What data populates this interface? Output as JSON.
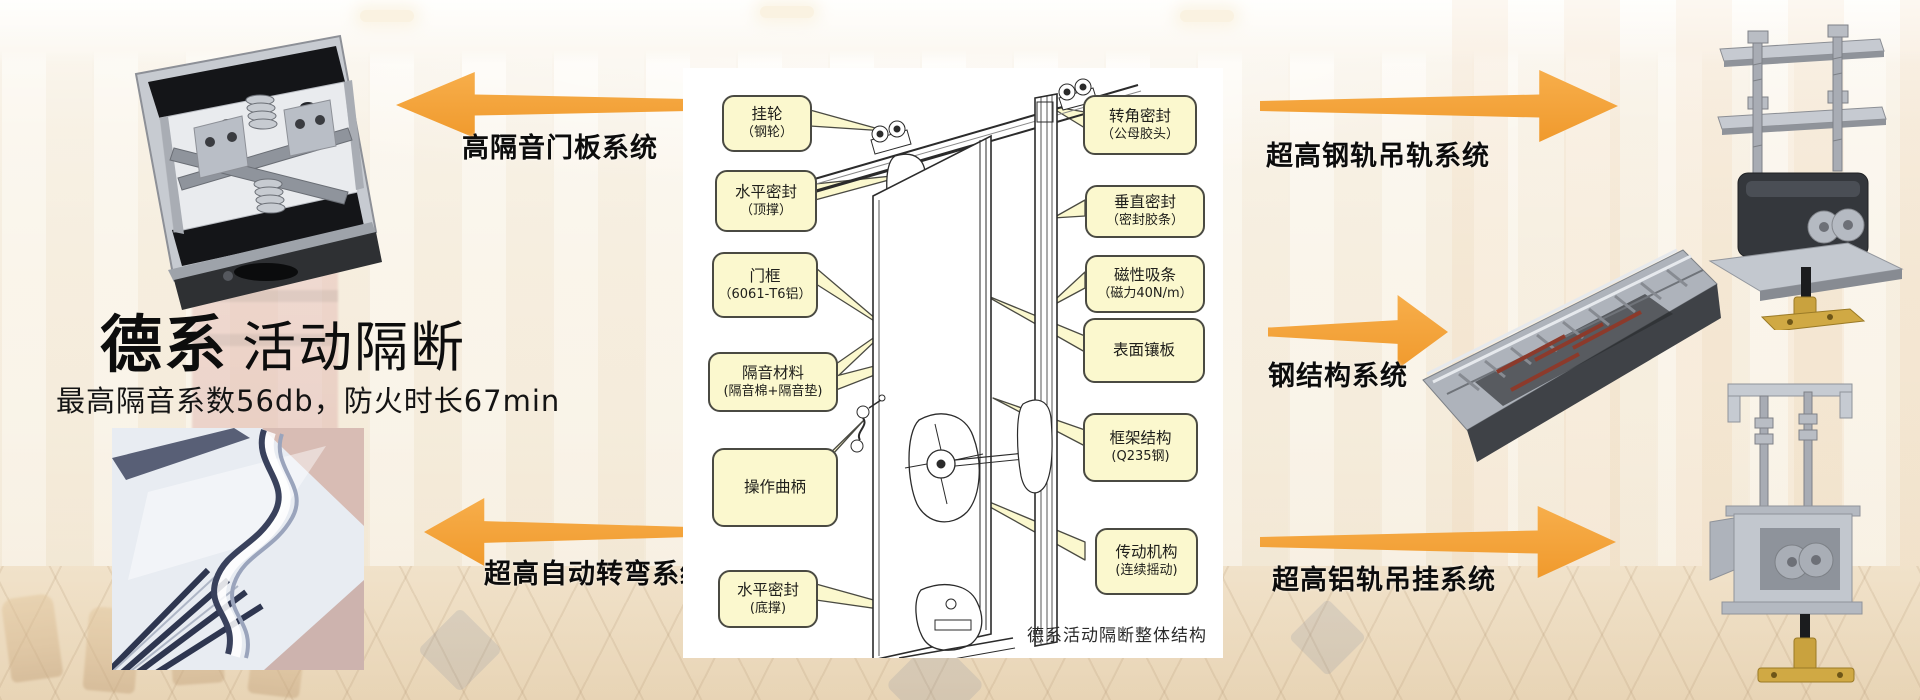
{
  "product": {
    "title_primary": "德系",
    "title_secondary": "活动隔断",
    "subtitle": "最高隔音系数56db，防火时长67min"
  },
  "callout_systems": {
    "left": [
      "高隔音门板系统",
      "超高自动转弯系统"
    ],
    "right": [
      "超高钢轨吊轨系统",
      "钢结构系统",
      "超高铝轨吊挂系统"
    ]
  },
  "diagram": {
    "caption": "德系活动隔断整体结构",
    "left_labels": [
      {
        "name": "挂轮",
        "detail": "（钢轮）"
      },
      {
        "name": "水平密封",
        "detail": "（顶撑）"
      },
      {
        "name": "门框",
        "detail": "（6061-T6铝）"
      },
      {
        "name": "隔音材料",
        "detail": "(隔音棉+隔音垫)"
      },
      {
        "name": "操作曲柄",
        "detail": ""
      },
      {
        "name": "水平密封",
        "detail": "(底撑)"
      }
    ],
    "right_labels": [
      {
        "name": "转角密封",
        "detail": "（公母胶头）"
      },
      {
        "name": "垂直密封",
        "detail": "（密封胶条）"
      },
      {
        "name": "磁性吸条",
        "detail": "（磁力40N/m）"
      },
      {
        "name": "表面镶板",
        "detail": ""
      },
      {
        "name": "框架结构",
        "detail": "(Q235钢)"
      },
      {
        "name": "传动机构",
        "detail": "(连续摇动)"
      }
    ]
  },
  "figures": {
    "top_left": "door-bottom-seal-mechanism-photo",
    "bottom_left": "curved-track-photo",
    "right_top": "steel-rail-hanger-photo",
    "right_middle": "steel-frame-structure-photo",
    "right_bottom": "aluminum-rail-hanger-photo"
  },
  "colors": {
    "arrow_orange": "#F5A540",
    "callout_bg": "#FBF8CE",
    "callout_border": "#4A4A42",
    "panel_bg": "#FFFFFF",
    "text": "#111111"
  }
}
